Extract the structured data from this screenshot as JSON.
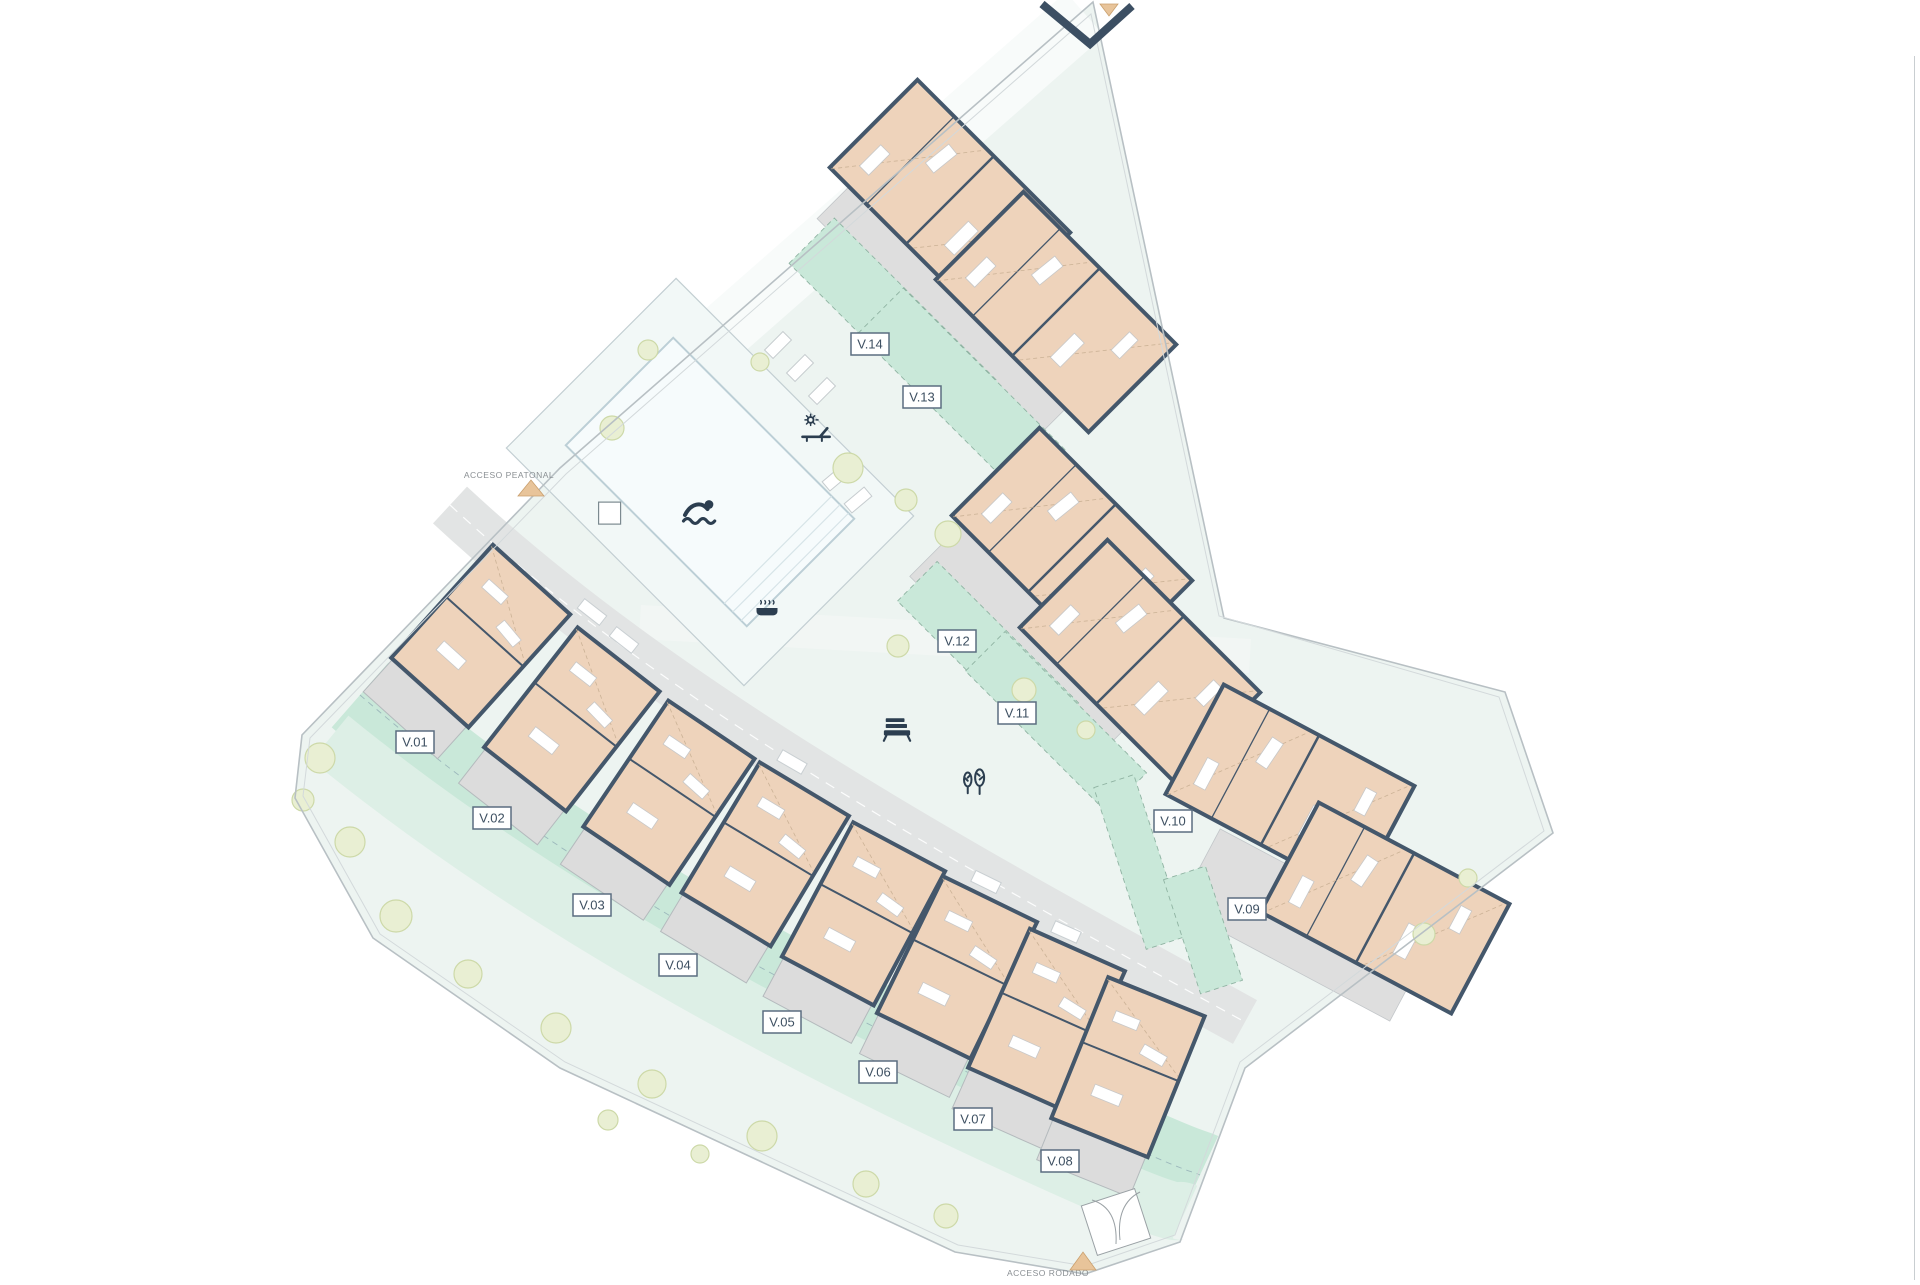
{
  "sheet": {
    "code": "V07"
  },
  "panel": {
    "title": "URBANIZACIÓN",
    "legend": [
      {
        "icon": "swimmer-icon",
        "label": "Piscina"
      },
      {
        "icon": "trees-icon",
        "label": "Zonas ajardinadas"
      },
      {
        "icon": "bench-icon",
        "label": "Zonas comunes"
      },
      {
        "icon": "sun-lounger-icon",
        "label": "Solarium"
      },
      {
        "icon": "jacuzzi-icon",
        "label": "Jacuzzi"
      }
    ],
    "compass": {
      "north_label": "N"
    },
    "energy": {
      "rating_letter": "A",
      "status": "En trámite"
    },
    "disclaimer": [
      "Documentación informativa sin carácter contractual y meramente ilustrativa sujeta a modificaciones necesarias por exigencias de orden técnico, jurídico o comercial de la dirección facultativa o autoridad competente.",
      "Las infografías de las fachadas, elementos comunes y restantes espacios orientativas y podrán ser objeto de verificación o modificación en los proyectos técnicos.",
      "El mobiliario de las infografías no está incluido. Los acabados, calidades, colores, equipamiento, aparatos sanitarios y muebles de cocina son una aproximación meramente representativa y el equipamiento de las viviendas será el indicado en la correspondiente memoria de calidades.",
      "La certificación energética se corresponde con la establecida en proyecto en trámite.",
      "El número de peldaños de escalera dibujados en este plano es orientativo, pudiendo variar durante el proceso constructivo por necesidades técnicas o adaptación a la topografía real de la parcela.",
      "Toda la información y entrega de documentación se llevará a cabo conforme a lo dispuesto en el Real Decreto 515/1989 y demás normas que pudieran complementarlo ya sean de carácter estatal o autonómico."
    ]
  },
  "plan": {
    "plots": [
      {
        "id": "V.01"
      },
      {
        "id": "V.02"
      },
      {
        "id": "V.03"
      },
      {
        "id": "V.04"
      },
      {
        "id": "V.05"
      },
      {
        "id": "V.06"
      },
      {
        "id": "V.07"
      },
      {
        "id": "V.08"
      },
      {
        "id": "V.09"
      },
      {
        "id": "V.10"
      },
      {
        "id": "V.11"
      },
      {
        "id": "V.12"
      },
      {
        "id": "V.13"
      },
      {
        "id": "V.14"
      }
    ],
    "access": [
      {
        "label": "ACCESO PEATONAL"
      },
      {
        "label": "ACCESO RODADO"
      }
    ]
  },
  "colors": {
    "accent_teal": "#2495a3",
    "wall": "#44576b",
    "building_fill": "#eed3bb",
    "garden_green": "#c9e8d9",
    "site_background": "#edf4f1",
    "terrace_gray": "#dcdcdc",
    "energy_scale": [
      "#00963f",
      "#52ae32",
      "#c8d400",
      "#ffed00",
      "#fbba00",
      "#ec6608",
      "#e30613"
    ]
  }
}
